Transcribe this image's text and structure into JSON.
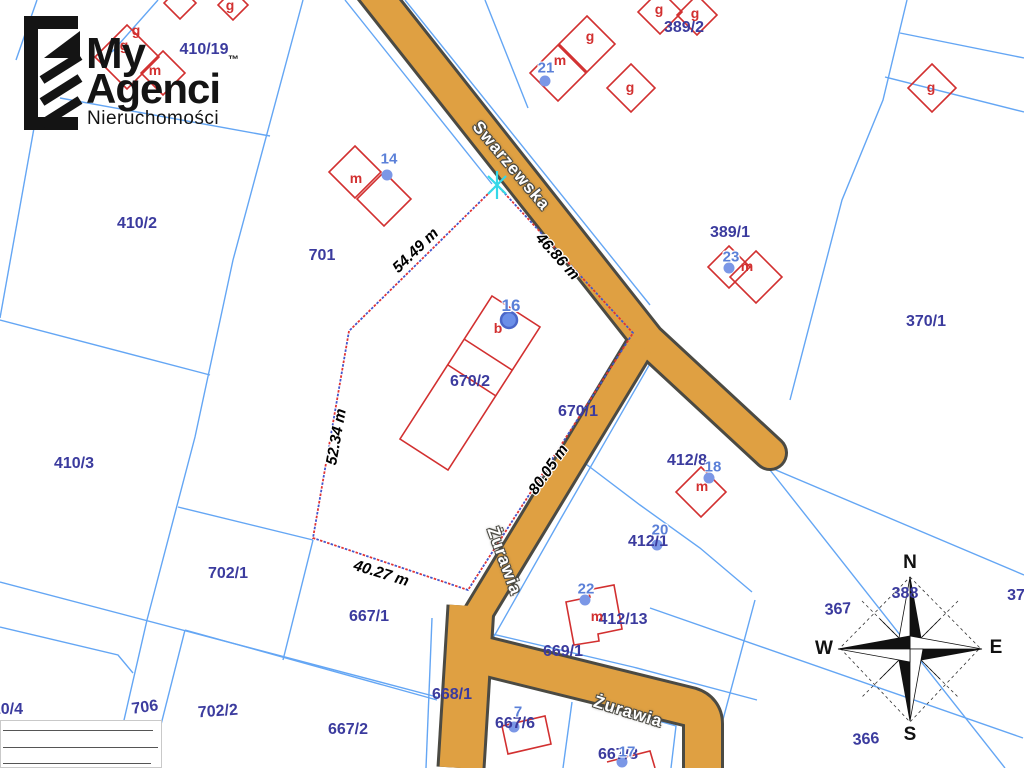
{
  "logo": {
    "line1": "My",
    "line2": "Agenci",
    "line3": "Nieruchomości",
    "trademark": "™"
  },
  "streets": {
    "swarzewska": "Swarzewska",
    "zurawia_vertical": "Żurawia",
    "zurawia_horizontal": "Żurawia"
  },
  "dimensions": {
    "d1": "54.49 m",
    "d2": "46.86 m",
    "d3": "52.34 m",
    "d4": "40.27 m",
    "d5": "80.05 m"
  },
  "parcels": {
    "p410_19": "410/19",
    "p410_2": "410/2",
    "p410_3": "410/3",
    "p410_4": "410/4",
    "p701": "701",
    "p702_1": "702/1",
    "p702_2": "702/2",
    "p706": "706",
    "p667_1": "667/1",
    "p667_2": "667/2",
    "p667_6": "667/6",
    "p667_8": "667/8",
    "p668_1": "668/1",
    "p669_1": "669/1",
    "p670_2": "670/2",
    "p670_1": "670/1",
    "p389_2": "389/2",
    "p389_1": "389/1",
    "p370_1": "370/1",
    "p412_8": "412/8",
    "p412_1": "412/1",
    "p412_13": "412/13",
    "p366": "366",
    "p367": "367",
    "p388": "388",
    "p37x": "37"
  },
  "addresses": {
    "a14": "14",
    "a16": "16",
    "a21": "21",
    "a23": "23",
    "a18": "18",
    "a20": "20",
    "a22": "22",
    "a7": "7",
    "a17": "17"
  },
  "building_letters": {
    "m": "m",
    "g": "g",
    "b": "b"
  },
  "compass": {
    "north": "N",
    "south": "S",
    "east": "E",
    "west": "W"
  },
  "colors": {
    "road_fill": "#dfa042",
    "road_casing": "#4b4a43",
    "parcel_line": "#64a6f4",
    "parcel_label": "#3b3b9e",
    "building_outline": "#d23030",
    "address_text": "#5b80d8",
    "address_dot": "#7b97e6",
    "selection_red": "#e23333",
    "selection_blue": "#4455cc",
    "marker_cyan": "#35d8e8",
    "dimension_text": "#000000"
  }
}
